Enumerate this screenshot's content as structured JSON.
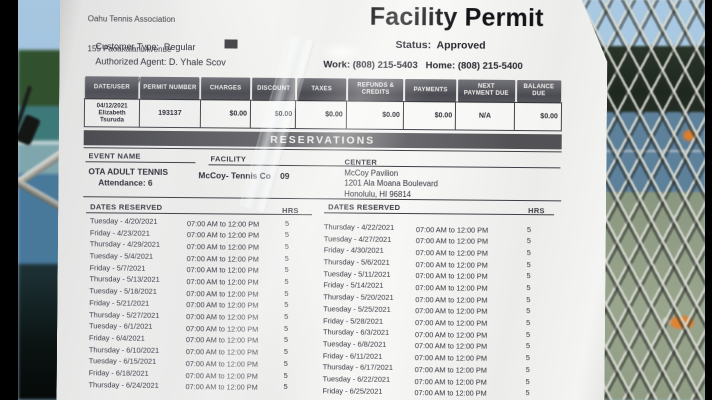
{
  "header": {
    "org_line_top": "Oahu Tennis Association",
    "org_address1": "155 Paoakalani Avenue",
    "org_address2": "Honolulu, HI  96815",
    "title": "Facility Permit",
    "status": "Status:  Approved",
    "customer_type": "Customer Type:  Regular",
    "authorized_agent": "Authorized Agent: D. Yhale Scov",
    "phones": "Work: (808) 215-5403   Home: (808) 215-5400"
  },
  "fee_table": {
    "columns": [
      "DATE/USER",
      "PERMIT NUMBER",
      "CHARGES",
      "DISCOUNT",
      "TAXES",
      "REFUNDS &\nCREDITS",
      "PAYMENTS",
      "NEXT\nPAYMENT DUE",
      "BALANCE\nDUE"
    ],
    "row": [
      "04/12/2021\nElizabeth\nTsuruda",
      "193137",
      "$0.00",
      "$0.00",
      "$0.00",
      "$0.00",
      "$0.00",
      "N/A",
      "$0.00"
    ]
  },
  "reservations": {
    "banner": "RESERVATIONS",
    "labels": {
      "event": "EVENT NAME",
      "facility": "FACILITY",
      "center": "CENTER",
      "dates": "DATES RESERVED",
      "hrs": "HRS"
    },
    "event_name": "OTA ADULT TENNIS",
    "attendance": "Attendance: 6",
    "facility": "McCoy- Tennis Co    09",
    "center_lines": [
      "McCoy Pavilion",
      "1201 Ala Moana Boulevard",
      "Honolulu, HI  96814"
    ],
    "time": "07:00 AM to 12:00 PM",
    "hours": "5",
    "left_dates": [
      "Tuesday - 4/20/2021",
      "Friday - 4/23/2021",
      "Thursday - 4/29/2021",
      "Tuesday - 5/4/2021",
      "Friday - 5/7/2021",
      "Thursday - 5/13/2021",
      "Tuesday - 5/18/2021",
      "Friday - 5/21/2021",
      "Thursday - 5/27/2021",
      "Tuesday - 6/1/2021",
      "Friday - 6/4/2021",
      "Thursday - 6/10/2021",
      "Tuesday - 6/15/2021",
      "Friday - 6/18/2021",
      "Thursday - 6/24/2021"
    ],
    "right_dates": [
      "Thursday - 4/22/2021",
      "Tuesday - 4/27/2021",
      "Friday - 4/30/2021",
      "Thursday - 5/6/2021",
      "Tuesday - 5/11/2021",
      "Friday - 5/14/2021",
      "Thursday - 5/20/2021",
      "Tuesday - 5/25/2021",
      "Friday - 5/28/2021",
      "Thursday - 6/3/2021",
      "Tuesday - 6/8/2021",
      "Friday - 6/11/2021",
      "Thursday - 6/17/2021",
      "Tuesday - 6/22/2021",
      "Friday - 6/25/2021"
    ]
  },
  "colors": {
    "paper": "#f3f3f0",
    "banner_gray": "#59595c",
    "sky": "#a7c7e1",
    "court_blue": "#5d809b",
    "court_teal": "#3e797a",
    "ground_sage": "#93a089",
    "windscreen": "#232c22",
    "accent_orange": "#df7f2e"
  }
}
